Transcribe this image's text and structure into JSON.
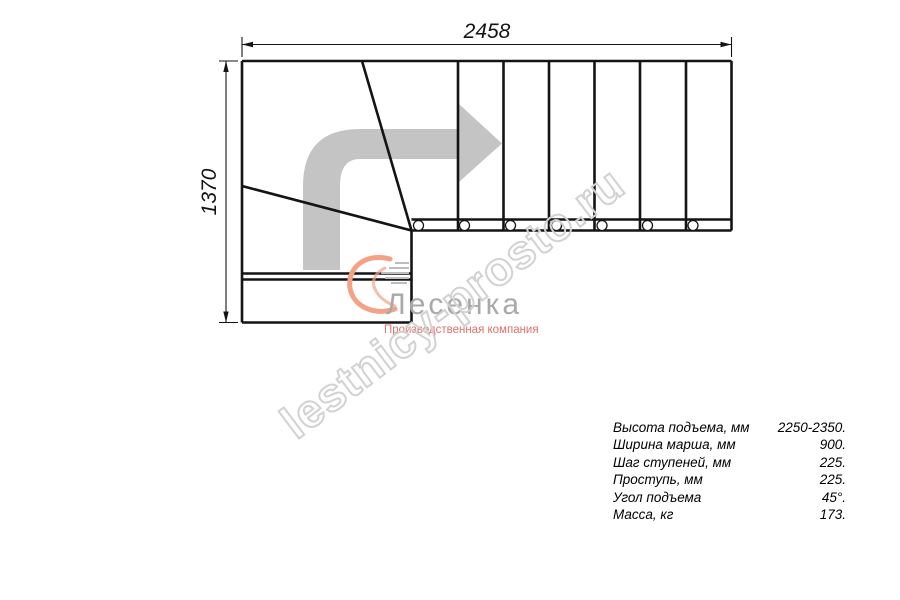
{
  "dimensions": {
    "width_label": "2458",
    "height_label": "1370"
  },
  "watermark": {
    "text": "lestnicy-prosto.ru"
  },
  "logo": {
    "name": "Лесенка",
    "tagline": "Производственная компания"
  },
  "specs": {
    "rows": [
      {
        "label": "Высота подъема, мм",
        "value": "2250-2350."
      },
      {
        "label": "Ширина марша, мм",
        "value": "900."
      },
      {
        "label": "Шаг ступеней, мм",
        "value": "225."
      },
      {
        "label": "Проступь, мм",
        "value": "225."
      },
      {
        "label": "Угол подъема",
        "value": "45°."
      },
      {
        "label": "Масса, кг",
        "value": "173."
      }
    ]
  },
  "colors": {
    "line": "#141414",
    "arrow": "#c4c4c4",
    "watermark_outline": "#d2d2d2",
    "logo_gray": "#a9a9a9",
    "logo_red": "#e0716b",
    "swoosh_orange": "#f4a285"
  }
}
